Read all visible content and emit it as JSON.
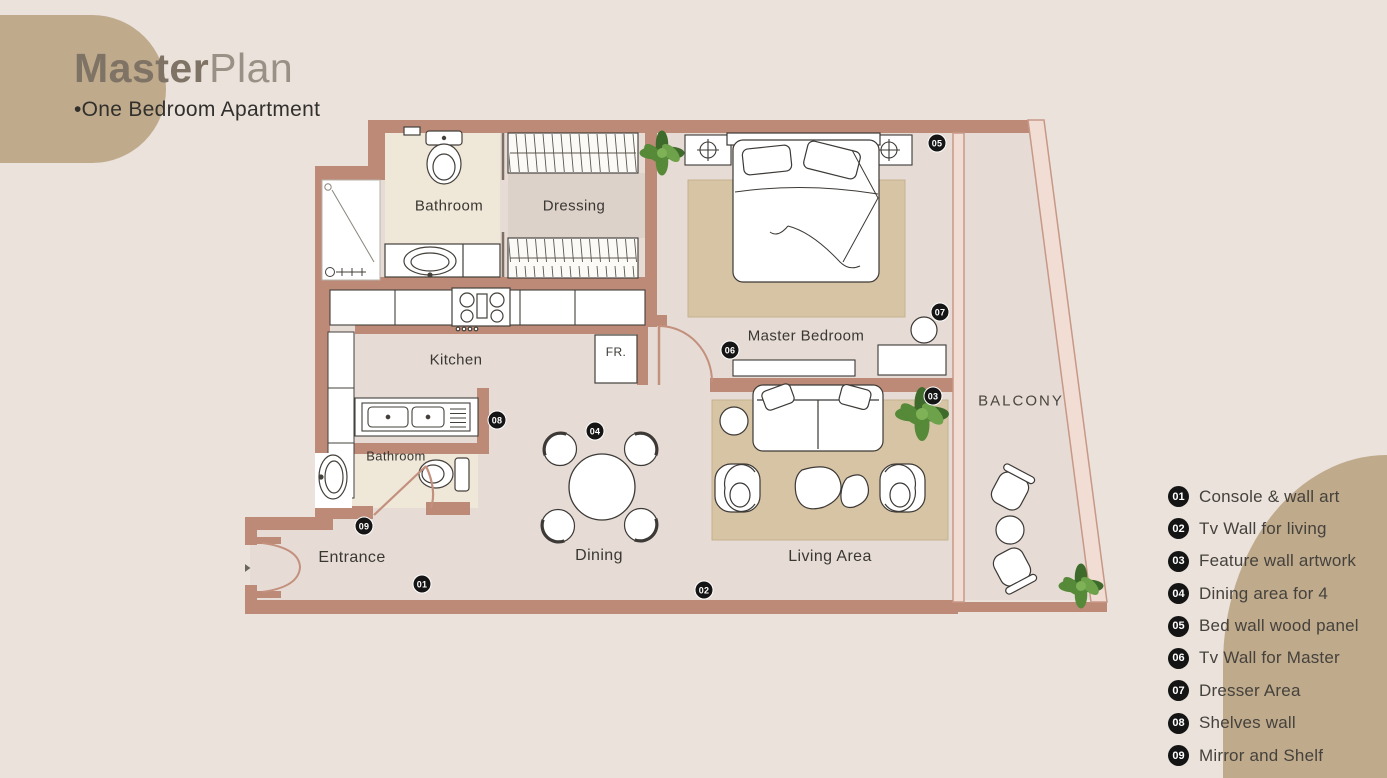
{
  "title": {
    "bold": "Master",
    "light": "Plan",
    "subtitle": "•One Bedroom Apartment"
  },
  "plan": {
    "rooms": [
      {
        "name": "Bathroom"
      },
      {
        "name": "Dressing"
      },
      {
        "name": "Kitchen"
      },
      {
        "name": "Master Bedroom"
      },
      {
        "name": "Dining"
      },
      {
        "name": "Living Area"
      },
      {
        "name": "Entrance"
      },
      {
        "name": "Bathroom"
      },
      {
        "name": "BALCONY"
      },
      {
        "name": "FR."
      }
    ],
    "badges": [
      {
        "num": "01"
      },
      {
        "num": "02"
      },
      {
        "num": "03"
      },
      {
        "num": "04"
      },
      {
        "num": "05"
      },
      {
        "num": "06"
      },
      {
        "num": "07"
      },
      {
        "num": "08"
      },
      {
        "num": "09"
      }
    ]
  },
  "legend": {
    "items": [
      {
        "num": "01",
        "label": "Console & wall art"
      },
      {
        "num": "02",
        "label": "Tv Wall for living"
      },
      {
        "num": "03",
        "label": "Feature wall artwork"
      },
      {
        "num": "04",
        "label": "Dining area for 4"
      },
      {
        "num": "05",
        "label": "Bed wall wood panel"
      },
      {
        "num": "06",
        "label": "Tv Wall for Master"
      },
      {
        "num": "07",
        "label": "Dresser Area"
      },
      {
        "num": "08",
        "label": "Shelves wall"
      },
      {
        "num": "09",
        "label": "Mirror and Shelf"
      }
    ]
  },
  "colors": {
    "background": "#eae2db",
    "blob": "#bfab8c",
    "wall": "#bc8a77",
    "wall_light": "#f2ddd4",
    "floor": "#e6dcd5",
    "bathroom_floor": "#efe7d8",
    "rug": "#d7c4a4",
    "badge": "#151515",
    "plant": "#4e7d33",
    "arrow": "#6b6560"
  }
}
